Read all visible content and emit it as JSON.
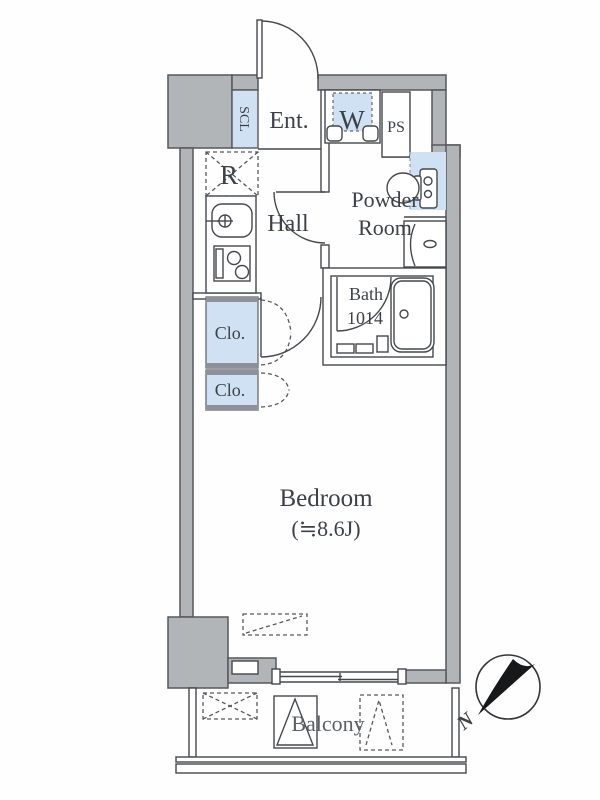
{
  "labels": {
    "entrance": "Ent.",
    "hall": "Hall",
    "powder1": "Powder",
    "powder2": "Room",
    "bath": "Bath",
    "bath_size": "1014",
    "bedroom": "Bedroom",
    "bedroom_size": "(≒8.6J)",
    "balcony": "Balcony",
    "shoe_closet": "SCL",
    "pipe_space": "PS",
    "washer": "W",
    "refrigerator": "R",
    "closet_upper": "Clo.",
    "closet_lower": "Clo.",
    "north": "N"
  },
  "colors": {
    "wall_fill": "#b2b5b8",
    "wall_stroke": "#55585c",
    "accent_blue": "#cfe1f2",
    "band_gray": "#8e9298",
    "line": "#45484d"
  }
}
